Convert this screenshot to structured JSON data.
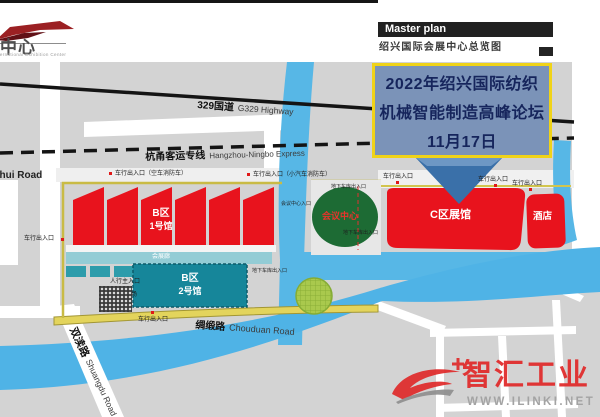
{
  "header": {
    "logo_cn": "会展中心",
    "logo_en": "Shaoxing International Exhibition Center",
    "master_plan_label": "Master plan",
    "subtitle": "绍兴国际会展中心总览图"
  },
  "annotation": {
    "line1": "2022年绍兴国际纺织",
    "line2": "机械智能制造高峰论坛",
    "line3": "11月17日"
  },
  "roads": {
    "g329_cn": "329国道",
    "g329_en": "G329 Highway",
    "express_cn": "杭甬客运专线",
    "express_en": "Hangzhou-Ningbo Express",
    "chouduan_cn": "绸缎路",
    "chouduan_en": "Chouduan Road",
    "shuangdu_cn": "双渎路",
    "shuangdu_en": "Shuangdu Road",
    "tuhui_en": "Tuhui Road"
  },
  "buildings": {
    "b1_line1": "B区",
    "b1_line2": "1号馆",
    "b2_line1": "B区",
    "b2_line2": "2号馆",
    "corridor": "会展廊",
    "conference": "会议中心",
    "hall_c": "C区展馆",
    "hotel": "酒店"
  },
  "entrances": [
    {
      "text": "车行出入口（空车消防车）"
    },
    {
      "text": "车行出入口（小汽车消防车）"
    },
    {
      "text": "车行出入口"
    },
    {
      "text": "车行出入口"
    },
    {
      "text": "车行出入口"
    },
    {
      "text": "车行出入口"
    },
    {
      "text": "车行出入口"
    },
    {
      "text": "人行主入口"
    },
    {
      "text": "会展前广场"
    },
    {
      "text": "地下车库出入口"
    },
    {
      "text": "地下车库出入口"
    },
    {
      "text": "地下车库出入口"
    },
    {
      "text": "会议中心入口"
    }
  ],
  "watermark": {
    "brand": "智汇工业",
    "site": "WWW.ILINKI.NET"
  },
  "colors": {
    "land": "#d3d3d3",
    "river": "#57b7e6",
    "hall_red": "#e8131d",
    "hall_teal": "#16869a",
    "corridor_teal": "#93ccd5",
    "conference_green": "#1d6b34",
    "ring_yellow": "#e3d45c",
    "annotation_bg": "#7b93b8",
    "annotation_border": "#f0d318",
    "annotation_text": "#16255c",
    "arrow_blue": "#3a70a9",
    "watermark_red": "#e02a2a"
  }
}
